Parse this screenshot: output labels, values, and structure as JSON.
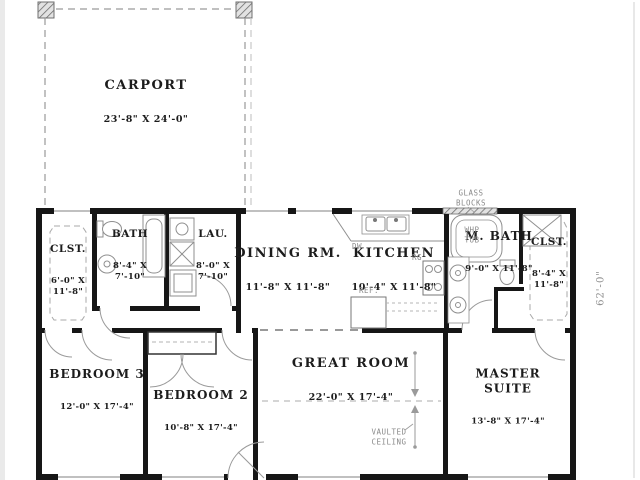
{
  "plan": {
    "rooms": [
      {
        "id": "carport",
        "name": "CARPORT",
        "dims": "23'-8\" X 24'-0\""
      },
      {
        "id": "clst-left",
        "name": "CLST.",
        "dims": "6'-0\" X\n11'-8\""
      },
      {
        "id": "bath",
        "name": "BATH",
        "dims": "8'-4\" X\n7'-10\""
      },
      {
        "id": "laundry",
        "name": "LAU.",
        "dims": "8'-0\" X\n7'-10\""
      },
      {
        "id": "dining",
        "name": "DINING RM.",
        "dims": "11'-8\" X 11'-8\""
      },
      {
        "id": "kitchen",
        "name": "KITCHEN",
        "dims": "10'-4\" X 11'-8\""
      },
      {
        "id": "master-bath",
        "name": "M. BATH",
        "dims": "9'-0\" X 11'-8\""
      },
      {
        "id": "clst-right",
        "name": "CLST.",
        "dims": "8'-4\" X\n11'-8\""
      },
      {
        "id": "bedroom-3",
        "name": "BEDROOM 3",
        "dims": "12'-0\" X 17'-4\""
      },
      {
        "id": "bedroom-2",
        "name": "BEDROOM 2",
        "dims": "10'-8\" X 17'-4\""
      },
      {
        "id": "great-room",
        "name": "GREAT ROOM",
        "dims": "22'-0\" X 17'-4\""
      },
      {
        "id": "master-suite",
        "name": "MASTER\nSUITE",
        "dims": "13'-8\" X 17'-4\""
      }
    ],
    "annotations": {
      "glass_blocks": "GLASS\nBLOCKS",
      "whp_tub": "WHP\nTUB",
      "dishwasher": "DW",
      "range": "RG",
      "refrigerator": "REF.",
      "vaulted_ceiling": "VAULTED\nCEILING",
      "side_dimension": "62'-0\""
    },
    "colors": {
      "wall": "#161616",
      "thin_line": "#9a9a9a",
      "annotation_text": "#8a8a8a",
      "room_text": "#1c1c1c",
      "background": "#ffffff"
    }
  }
}
